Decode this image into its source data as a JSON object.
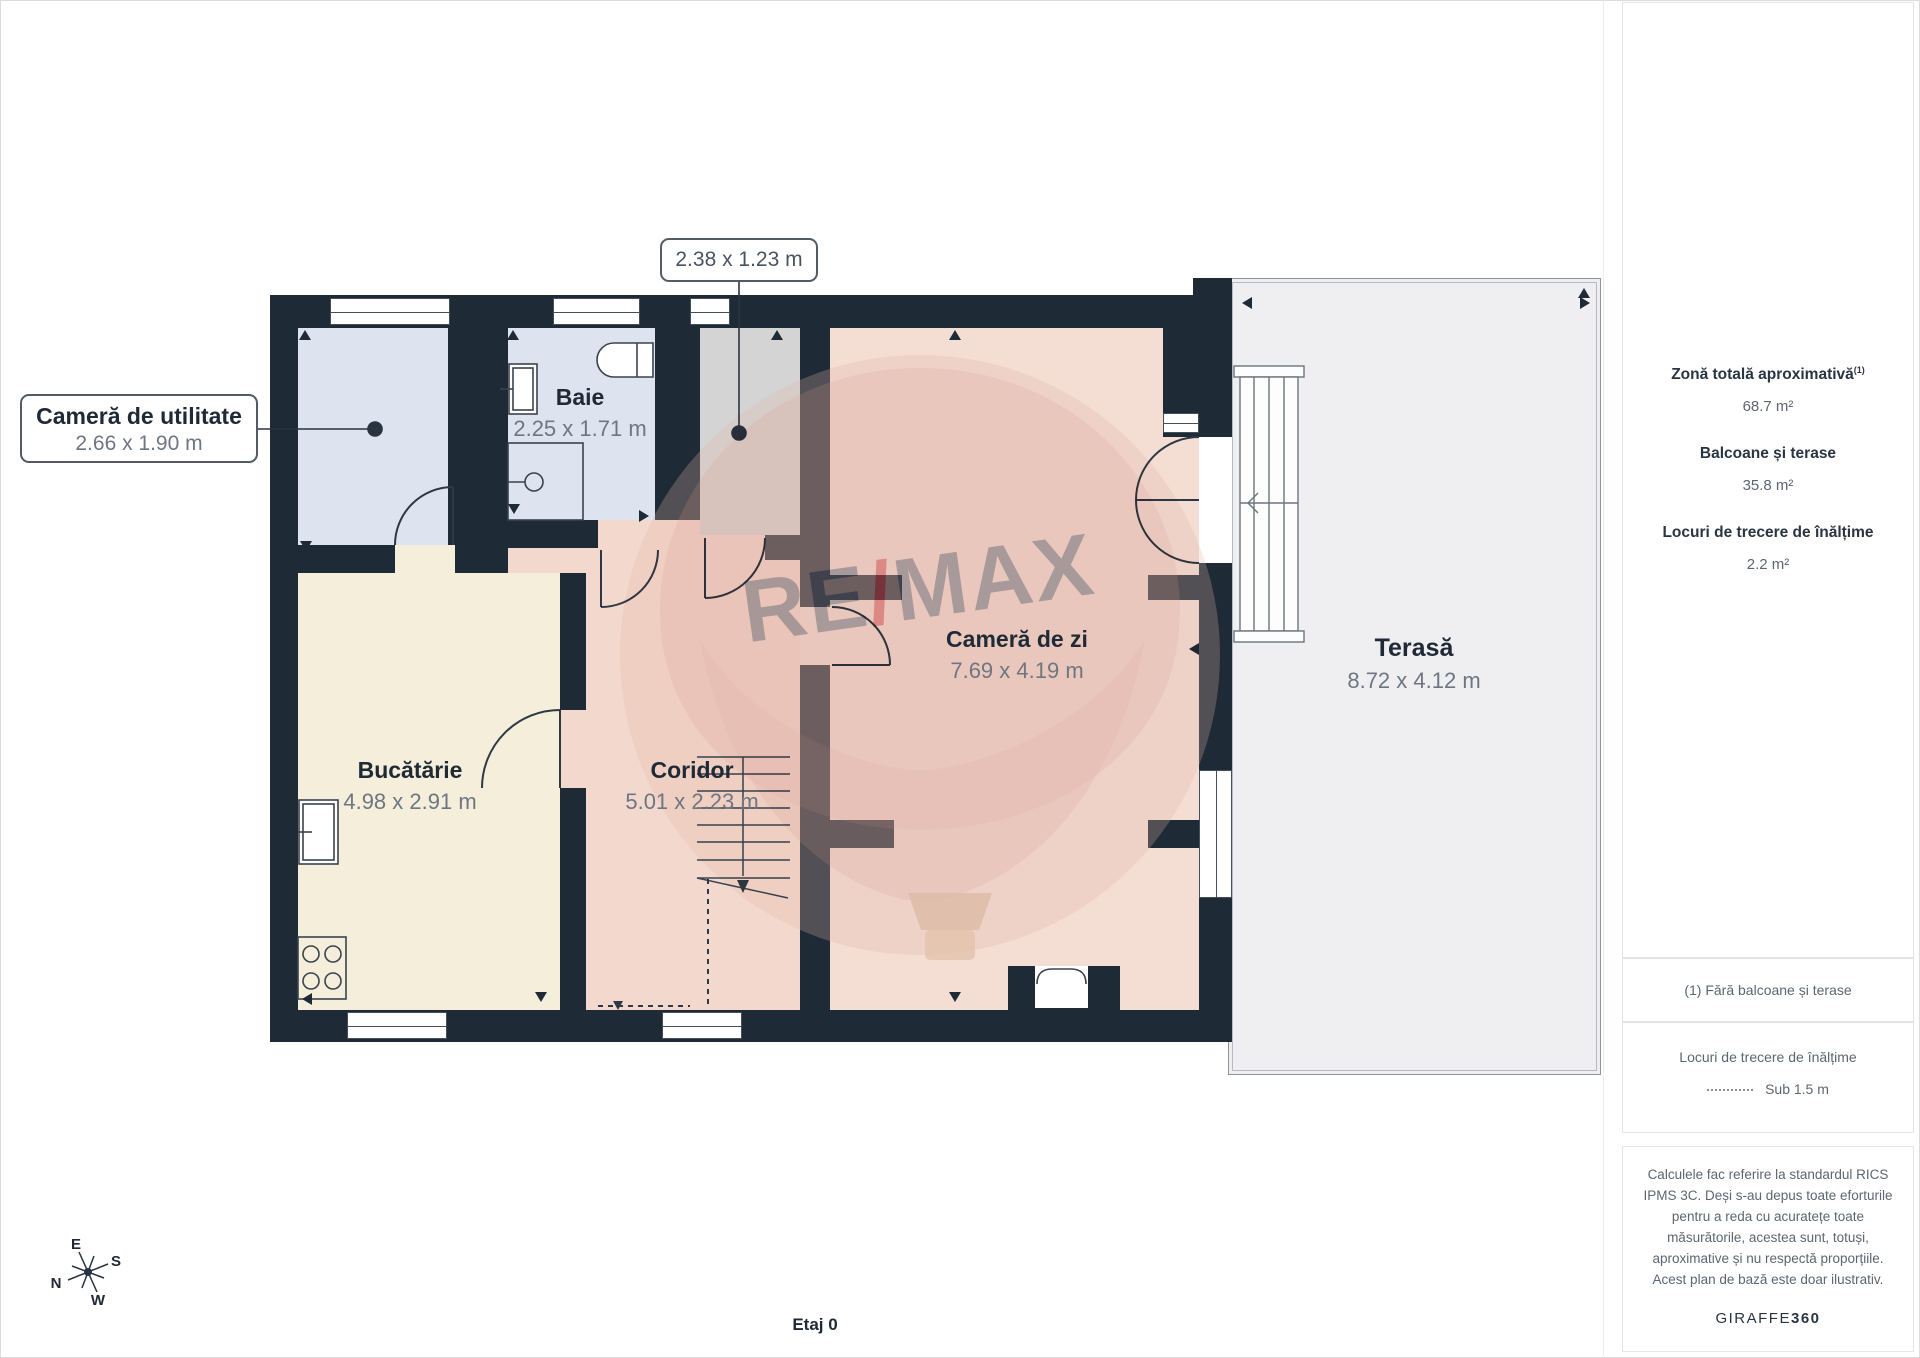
{
  "plan": {
    "floor_label": "Etaj 0",
    "rooms": [
      {
        "id": "utility",
        "name": "Cameră de utilitate",
        "dims": "2.66 x 1.90 m"
      },
      {
        "id": "baie",
        "name": "Baie",
        "dims": "2.25 x 1.71 m"
      },
      {
        "id": "stairwell",
        "dims": "2.38 x 1.23 m"
      },
      {
        "id": "bucatarie",
        "name": "Bucătărie",
        "dims": "4.98 x 2.91 m"
      },
      {
        "id": "coridor",
        "name": "Coridor",
        "dims": "5.01 x 2.23 m"
      },
      {
        "id": "camera_de_zi",
        "name": "Cameră de zi",
        "dims": "7.69 x 4.19 m"
      },
      {
        "id": "terasa",
        "name": "Terasă",
        "dims": "8.72 x 4.12 m"
      }
    ],
    "compass": {
      "e": "E",
      "s": "S",
      "n": "N",
      "w": "W"
    },
    "watermark": {
      "re": "RE",
      "slash": "/",
      "max": "MAX"
    }
  },
  "sidebar": {
    "stats": [
      {
        "label": "Zonă totală aproximativă",
        "sup": "(1)",
        "value": "68.7 m²"
      },
      {
        "label": "Balcoane și terase",
        "value": "35.8 m²"
      },
      {
        "label": "Locuri de trecere de înălțime",
        "value": "2.2 m²"
      }
    ],
    "footnote": "(1) Fără balcoane și terase",
    "legend": {
      "title": "Locuri de trecere de înălțime",
      "item": "Sub 1.5 m"
    },
    "disclaimer": "Calculele fac referire la standardul RICS IPMS 3C. Deși s-au depus toate eforturile pentru a reda cu acuratețe toate măsurătorile, acestea sunt, totuși, aproximative și nu respectă proporțiile. Acest plan de bază este doar ilustrativ.",
    "brand": {
      "name": "GIRAFFE",
      "bold": "360"
    }
  },
  "colors": {
    "wall": "#1e2a36",
    "room_wet": "#dde3ef",
    "room_hall": "#d3d4d3",
    "room_kitchen": "#f4eedb",
    "room_corridor": "#f3d9cd",
    "room_living": "#f4ddd3",
    "terrace": "#efeff1",
    "accent_red": "#c2252e",
    "label_dark": "#202a36",
    "label_gray": "#6e7681"
  }
}
